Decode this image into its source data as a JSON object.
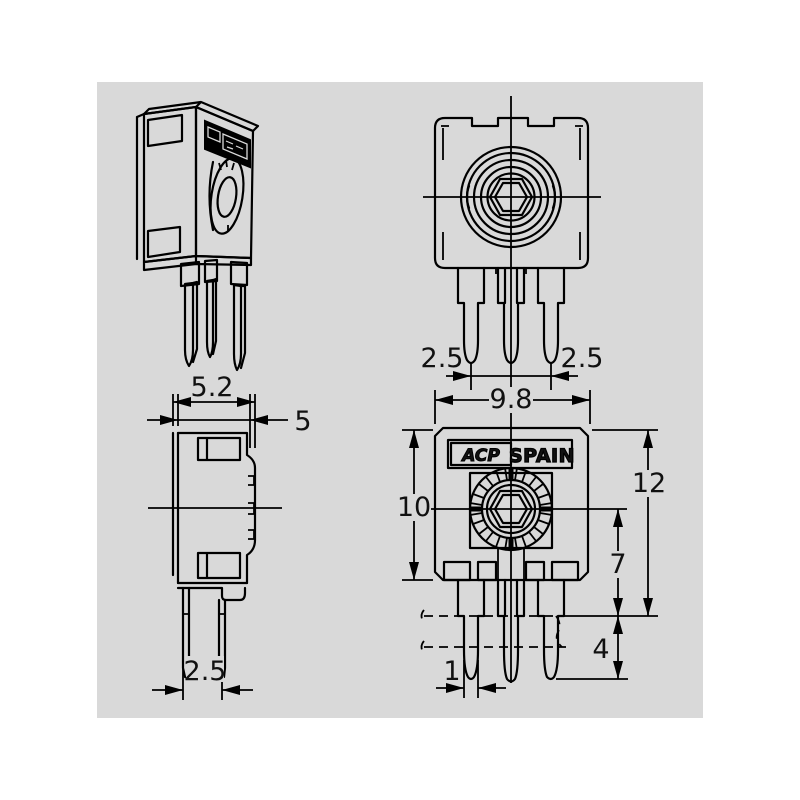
{
  "colors": {
    "panel": "#d9d9d9",
    "line": "#000000",
    "background": "#ffffff"
  },
  "brand": {
    "logo_text": "ACP",
    "country_label": "SPAIN"
  },
  "dimensions": {
    "front_view": {
      "pin_pitch_left": "2.5",
      "pin_pitch_right": "2.5"
    },
    "side_view": {
      "overall_depth": "5.2",
      "body_depth": "5",
      "pin_pitch": "2.5"
    },
    "back_view": {
      "body_width": "9.8",
      "body_height": "10",
      "overall_height": "12",
      "center_to_seating": "7",
      "pin_protrusion": "4",
      "pin_width": "1"
    }
  }
}
